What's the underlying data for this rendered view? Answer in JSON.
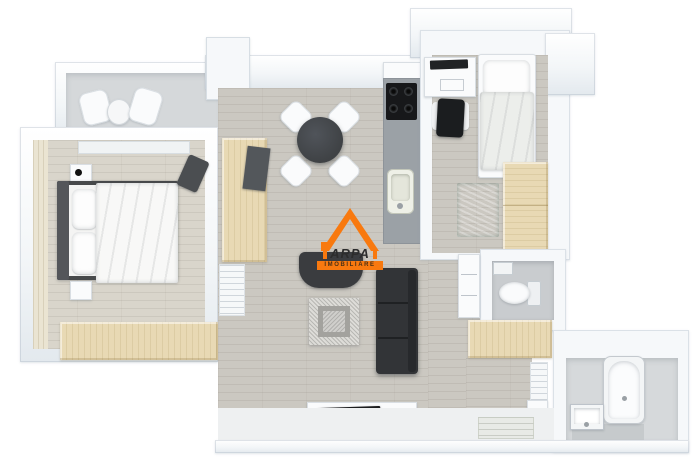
{
  "logo": {
    "name": "ARPA",
    "tagline": "IMOBILIARE"
  },
  "colors": {
    "orange": "#F8790F",
    "livingFloor": "#cbc8c1",
    "bedroomFloor": "#d9d5cb",
    "balconyFloor": "#d5d8da",
    "tileFloor": "#c9cccf",
    "hallFloor": "#eef0f1",
    "beigeWall": "#eae4d2",
    "wood": "#e8d9b4",
    "counter": "#9ba1a6",
    "cooktop": "#17181a",
    "sofa": "#323437",
    "armchair": "#3a3c3f",
    "table": "#3f4245",
    "headboard": "#54565a",
    "bedFrame": "#47494b",
    "darkChair": "#4b4e51",
    "panel": "#53575b",
    "tv": "#1c1d1f",
    "monitor": "#212325",
    "deskChair": "#1b1d1f",
    "maroon": "#7a3430",
    "ottomanLight": "#dddcd8",
    "ottomanMid": "#a3a29e",
    "ottomanCenter": "#cfcecb"
  }
}
